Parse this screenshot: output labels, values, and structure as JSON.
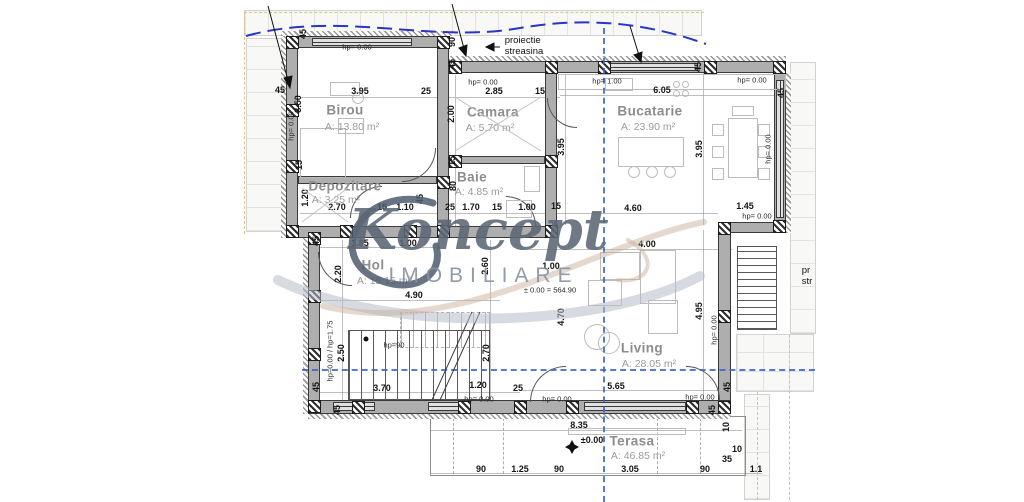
{
  "watermark": {
    "brand": "Koncept",
    "sub": "IMOBILIARE"
  },
  "rooms": [
    {
      "name": "Birou",
      "area": "A: 13.80 m²",
      "x": 345,
      "y": 110,
      "ax": 352,
      "ay": 127
    },
    {
      "name": "Camara",
      "area": "A: 5.70 m²",
      "x": 493,
      "y": 112,
      "ax": 490,
      "ay": 128
    },
    {
      "name": "Bucatarie",
      "area": "A: 23.90 m²",
      "x": 650,
      "y": 111,
      "ax": 648,
      "ay": 127
    },
    {
      "name": "Depozitare",
      "area": "A: 3.25 m²",
      "x": 345,
      "y": 186,
      "ax": 336,
      "ay": 200
    },
    {
      "name": "Baie",
      "area": "A: 4.85 m²",
      "x": 472,
      "y": 177,
      "ax": 479,
      "ay": 192
    },
    {
      "name": "Hol",
      "area": "A: 15.15 m²",
      "x": 373,
      "y": 265,
      "ax": 384,
      "ay": 281
    },
    {
      "name": "Living",
      "area": "A: 28.05 m²",
      "x": 642,
      "y": 348,
      "ax": 649,
      "ay": 364
    },
    {
      "name": "Terasa",
      "area": "A: 46.85 m²",
      "x": 632,
      "y": 441,
      "ax": 638,
      "ay": 456
    }
  ],
  "labels": [
    {
      "t": "45",
      "x": 303,
      "y": 34,
      "r": 1
    },
    {
      "t": "hp= 0.00",
      "x": 357,
      "y": 47,
      "k": "hp"
    },
    {
      "t": "proiectie\nstreasina",
      "x": 524,
      "y": 47,
      "k": "note"
    },
    {
      "t": "3.95",
      "x": 360,
      "y": 91
    },
    {
      "t": "25",
      "x": 426,
      "y": 91
    },
    {
      "t": "90",
      "x": 452,
      "y": 42,
      "r": 1
    },
    {
      "t": "45",
      "x": 452,
      "y": 64,
      "r": 1
    },
    {
      "t": "hp= 0.00",
      "x": 483,
      "y": 82,
      "k": "hp"
    },
    {
      "t": "2.85",
      "x": 494,
      "y": 91
    },
    {
      "t": "15",
      "x": 540,
      "y": 91
    },
    {
      "t": "hp= 1.00",
      "x": 607,
      "y": 81,
      "k": "hp"
    },
    {
      "t": "6.05",
      "x": 662,
      "y": 90
    },
    {
      "t": "45",
      "x": 698,
      "y": 67,
      "r": 1
    },
    {
      "t": "hp= 0.00",
      "x": 752,
      "y": 80,
      "k": "hp"
    },
    {
      "t": "45",
      "x": 781,
      "y": 93,
      "r": 1
    },
    {
      "t": "45",
      "x": 280,
      "y": 90
    },
    {
      "t": "3.50",
      "x": 298,
      "y": 104,
      "r": 1
    },
    {
      "t": "hp= 0.00",
      "x": 291,
      "y": 126,
      "r": 1,
      "k": "hp"
    },
    {
      "t": "2.00",
      "x": 451,
      "y": 114,
      "r": 1
    },
    {
      "t": "3.95",
      "x": 561,
      "y": 147,
      "r": 1
    },
    {
      "t": "3.95",
      "x": 699,
      "y": 149,
      "r": 1
    },
    {
      "t": "hp= 0.00",
      "x": 768,
      "y": 149,
      "r": 1,
      "k": "hp"
    },
    {
      "t": "15",
      "x": 299,
      "y": 165,
      "r": 1
    },
    {
      "t": "1.20",
      "x": 305,
      "y": 198,
      "r": 1
    },
    {
      "t": "15",
      "x": 452,
      "y": 161,
      "r": 1
    },
    {
      "t": "80",
      "x": 453,
      "y": 186,
      "r": 1
    },
    {
      "t": "2.70",
      "x": 337,
      "y": 207
    },
    {
      "t": "15",
      "x": 382,
      "y": 207
    },
    {
      "t": "1.10",
      "x": 405,
      "y": 207
    },
    {
      "t": "45",
      "x": 420,
      "y": 199,
      "r": 1
    },
    {
      "t": "25",
      "x": 450,
      "y": 207
    },
    {
      "t": "1.70",
      "x": 471,
      "y": 207
    },
    {
      "t": "15",
      "x": 497,
      "y": 207
    },
    {
      "t": "1.00",
      "x": 527,
      "y": 207
    },
    {
      "t": "15",
      "x": 556,
      "y": 206
    },
    {
      "t": "4.60",
      "x": 633,
      "y": 208
    },
    {
      "t": "1.45",
      "x": 745,
      "y": 206
    },
    {
      "t": "hp= 0.00",
      "x": 757,
      "y": 216,
      "k": "hp"
    },
    {
      "t": "45",
      "x": 316,
      "y": 241,
      "r": 1
    },
    {
      "t": "1.85",
      "x": 360,
      "y": 243
    },
    {
      "t": "1.00",
      "x": 408,
      "y": 243
    },
    {
      "t": "2.20",
      "x": 338,
      "y": 274,
      "r": 1
    },
    {
      "t": "2.60",
      "x": 485,
      "y": 266,
      "r": 1
    },
    {
      "t": "1.00",
      "x": 551,
      "y": 266
    },
    {
      "t": "4.90",
      "x": 414,
      "y": 295
    },
    {
      "t": "4.00",
      "x": 647,
      "y": 244
    },
    {
      "t": "± 0.00 = 564.90",
      "x": 550,
      "y": 290,
      "k": "hp"
    },
    {
      "t": "4.70",
      "x": 561,
      "y": 317,
      "r": 1
    },
    {
      "t": "4.95",
      "x": 699,
      "y": 311,
      "r": 1
    },
    {
      "t": "hp= 0.00",
      "x": 714,
      "y": 330,
      "r": 1,
      "k": "hp"
    },
    {
      "t": "pr\nstr",
      "x": 807,
      "y": 277,
      "k": "note"
    },
    {
      "t": "hp=0.00 / hp=1.75",
      "x": 330,
      "y": 351,
      "r": 1,
      "k": "hp"
    },
    {
      "t": "2.50",
      "x": 341,
      "y": 353,
      "r": 1
    },
    {
      "t": "hp=90",
      "x": 394,
      "y": 345,
      "k": "hp"
    },
    {
      "t": "2.70",
      "x": 486,
      "y": 353,
      "r": 1
    },
    {
      "t": "5.65",
      "x": 616,
      "y": 386
    },
    {
      "t": "3.70",
      "x": 382,
      "y": 388
    },
    {
      "t": "1.20",
      "x": 478,
      "y": 385
    },
    {
      "t": "25",
      "x": 518,
      "y": 388
    },
    {
      "t": "45",
      "x": 316,
      "y": 387,
      "r": 1
    },
    {
      "t": "45",
      "x": 337,
      "y": 410,
      "r": 1
    },
    {
      "t": "hp= 0.00",
      "x": 479,
      "y": 399,
      "k": "hp"
    },
    {
      "t": "hp= 0.00",
      "x": 557,
      "y": 399,
      "k": "hp"
    },
    {
      "t": "hp= 0.00",
      "x": 700,
      "y": 397,
      "k": "hp"
    },
    {
      "t": "45",
      "x": 727,
      "y": 387,
      "r": 1
    },
    {
      "t": "45",
      "x": 712,
      "y": 410,
      "r": 1
    },
    {
      "t": "8.35",
      "x": 579,
      "y": 425
    },
    {
      "t": "±0.00",
      "x": 592,
      "y": 440
    },
    {
      "t": "10",
      "x": 726,
      "y": 427,
      "r": 1
    },
    {
      "t": "10",
      "x": 737,
      "y": 449
    },
    {
      "t": "35",
      "x": 727,
      "y": 459
    },
    {
      "t": "90",
      "x": 481,
      "y": 469
    },
    {
      "t": "1.25",
      "x": 520,
      "y": 469
    },
    {
      "t": "90",
      "x": 559,
      "y": 469
    },
    {
      "t": "3.05",
      "x": 630,
      "y": 469
    },
    {
      "t": "90",
      "x": 705,
      "y": 469
    },
    {
      "t": "1.1",
      "x": 756,
      "y": 469
    }
  ]
}
